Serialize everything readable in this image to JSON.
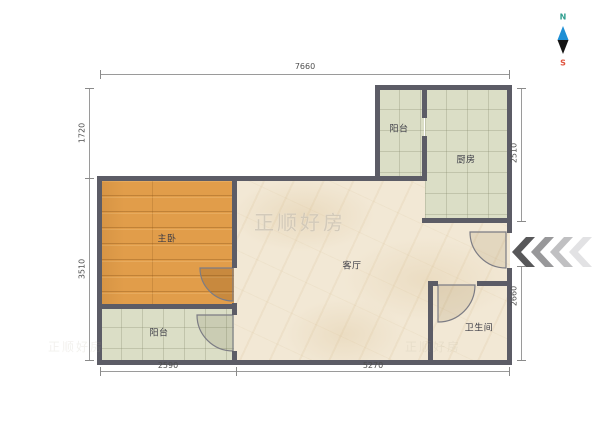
{
  "compass": {
    "north": "N",
    "south": "S"
  },
  "watermark": {
    "text": "正顺好房"
  },
  "rooms": {
    "balcony_top": "阳台",
    "kitchen": "厨房",
    "master_bedroom": "主卧",
    "living_room": "客厅",
    "balcony_bottom": "阳台",
    "bathroom": "卫生间"
  },
  "dimensions": {
    "top": "7660",
    "left_upper": "1720",
    "left_lower": "3510",
    "right_upper": "2510",
    "right_lower": "2660",
    "bottom_left": "2590",
    "bottom_right": "5270"
  },
  "colors": {
    "wall": "#5c5c66",
    "wood_floor": "#e19d4a",
    "tile_floor": "#dbdec6",
    "marble_floor": "#f2e8d5",
    "compass_north": "#2f9e8f",
    "compass_south": "#e0543f",
    "compass_arrow_top": "#1e8fd5",
    "compass_arrow_bottom": "#141414"
  }
}
